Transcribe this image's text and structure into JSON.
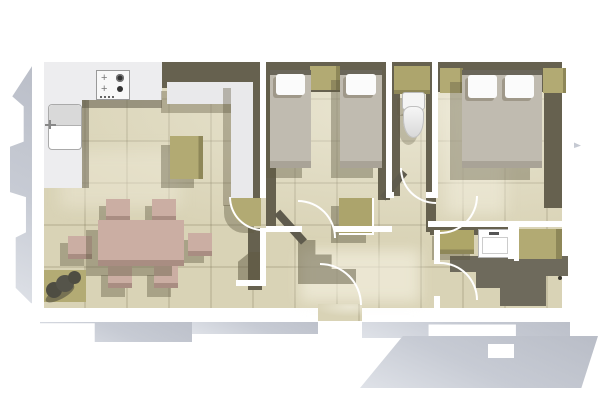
{
  "meta": {
    "description": "Top-down 3D architectural floor plan render of a furnished apartment with open kitchen-living room, two bedrooms, WC, bathroom and entrance hall; white walls, beige tiled floors and gray cast shadows on a white background",
    "view": "top-down axonometric render",
    "visible_text": "",
    "background_color": "#ffffff",
    "canvas": {
      "width_px": 600,
      "height_px": 400
    }
  },
  "palette": {
    "floor_tile": "#d9d3b6",
    "tile_joint": "#6e6852",
    "wall_top": "#ffffff",
    "wall_face_shadow": "#66614f",
    "exterior_drop_shadow": "#c3c7d0",
    "furniture_olive": "#b2aa73",
    "dining_rose": "#cbaea3",
    "bed_upholstery": "#c0bbb0",
    "pillow_white": "#fbfbfb",
    "kitchen_counter": "#ededef",
    "sanitary_white": "#f6f6f6"
  },
  "rooms": [
    {
      "id": "living-kitchen",
      "label": "Open-plan kitchen and living-dining room",
      "furniture": [
        "L-shaped kitchen counter",
        "4-burner hob",
        "kitchen sink",
        "kitchen island unit",
        "L-shaped sofa",
        "rounded corner side unit",
        "dining table",
        "six dining chairs",
        "potted plant on mat"
      ]
    },
    {
      "id": "bedroom-twin",
      "label": "Bedroom with two single beds",
      "furniture": [
        "single bed left",
        "single bed right",
        "bedside table"
      ]
    },
    {
      "id": "wc",
      "label": "Separate WC",
      "furniture": [
        "toilet",
        "cistern shelf"
      ]
    },
    {
      "id": "bedroom-double",
      "label": "Bedroom with double bed",
      "furniture": [
        "double bed",
        "bedside table left",
        "bedside table right"
      ]
    },
    {
      "id": "bathroom",
      "label": "Bathroom",
      "furniture": [
        "storage/washer unit",
        "washbasin",
        "shower unit"
      ]
    },
    {
      "id": "hallway",
      "label": "Entrance hallway",
      "furniture": [
        "hall cabinet"
      ]
    }
  ],
  "doors": {
    "count": 6,
    "style": "white quarter-circle swing arcs"
  },
  "lighting": {
    "direction": "from upper right",
    "shadow_style": "hard offset shadows toward lower left"
  }
}
